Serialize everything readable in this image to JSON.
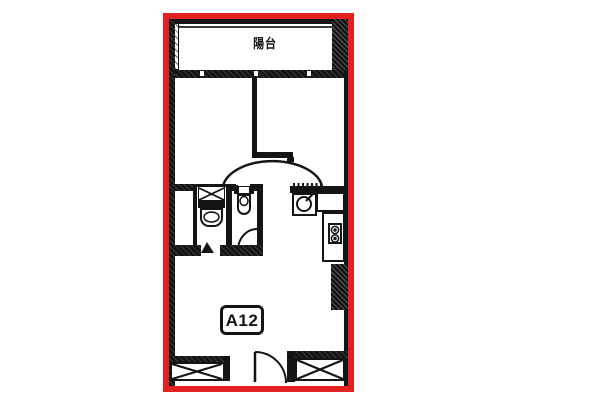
{
  "meta": {
    "type": "apartment-floor-plan"
  },
  "frame": {
    "border_color": "#e32120",
    "wall_color": "#141414",
    "background": "#ffffff"
  },
  "labels": {
    "balcony": "陽台",
    "unit": "A12"
  }
}
